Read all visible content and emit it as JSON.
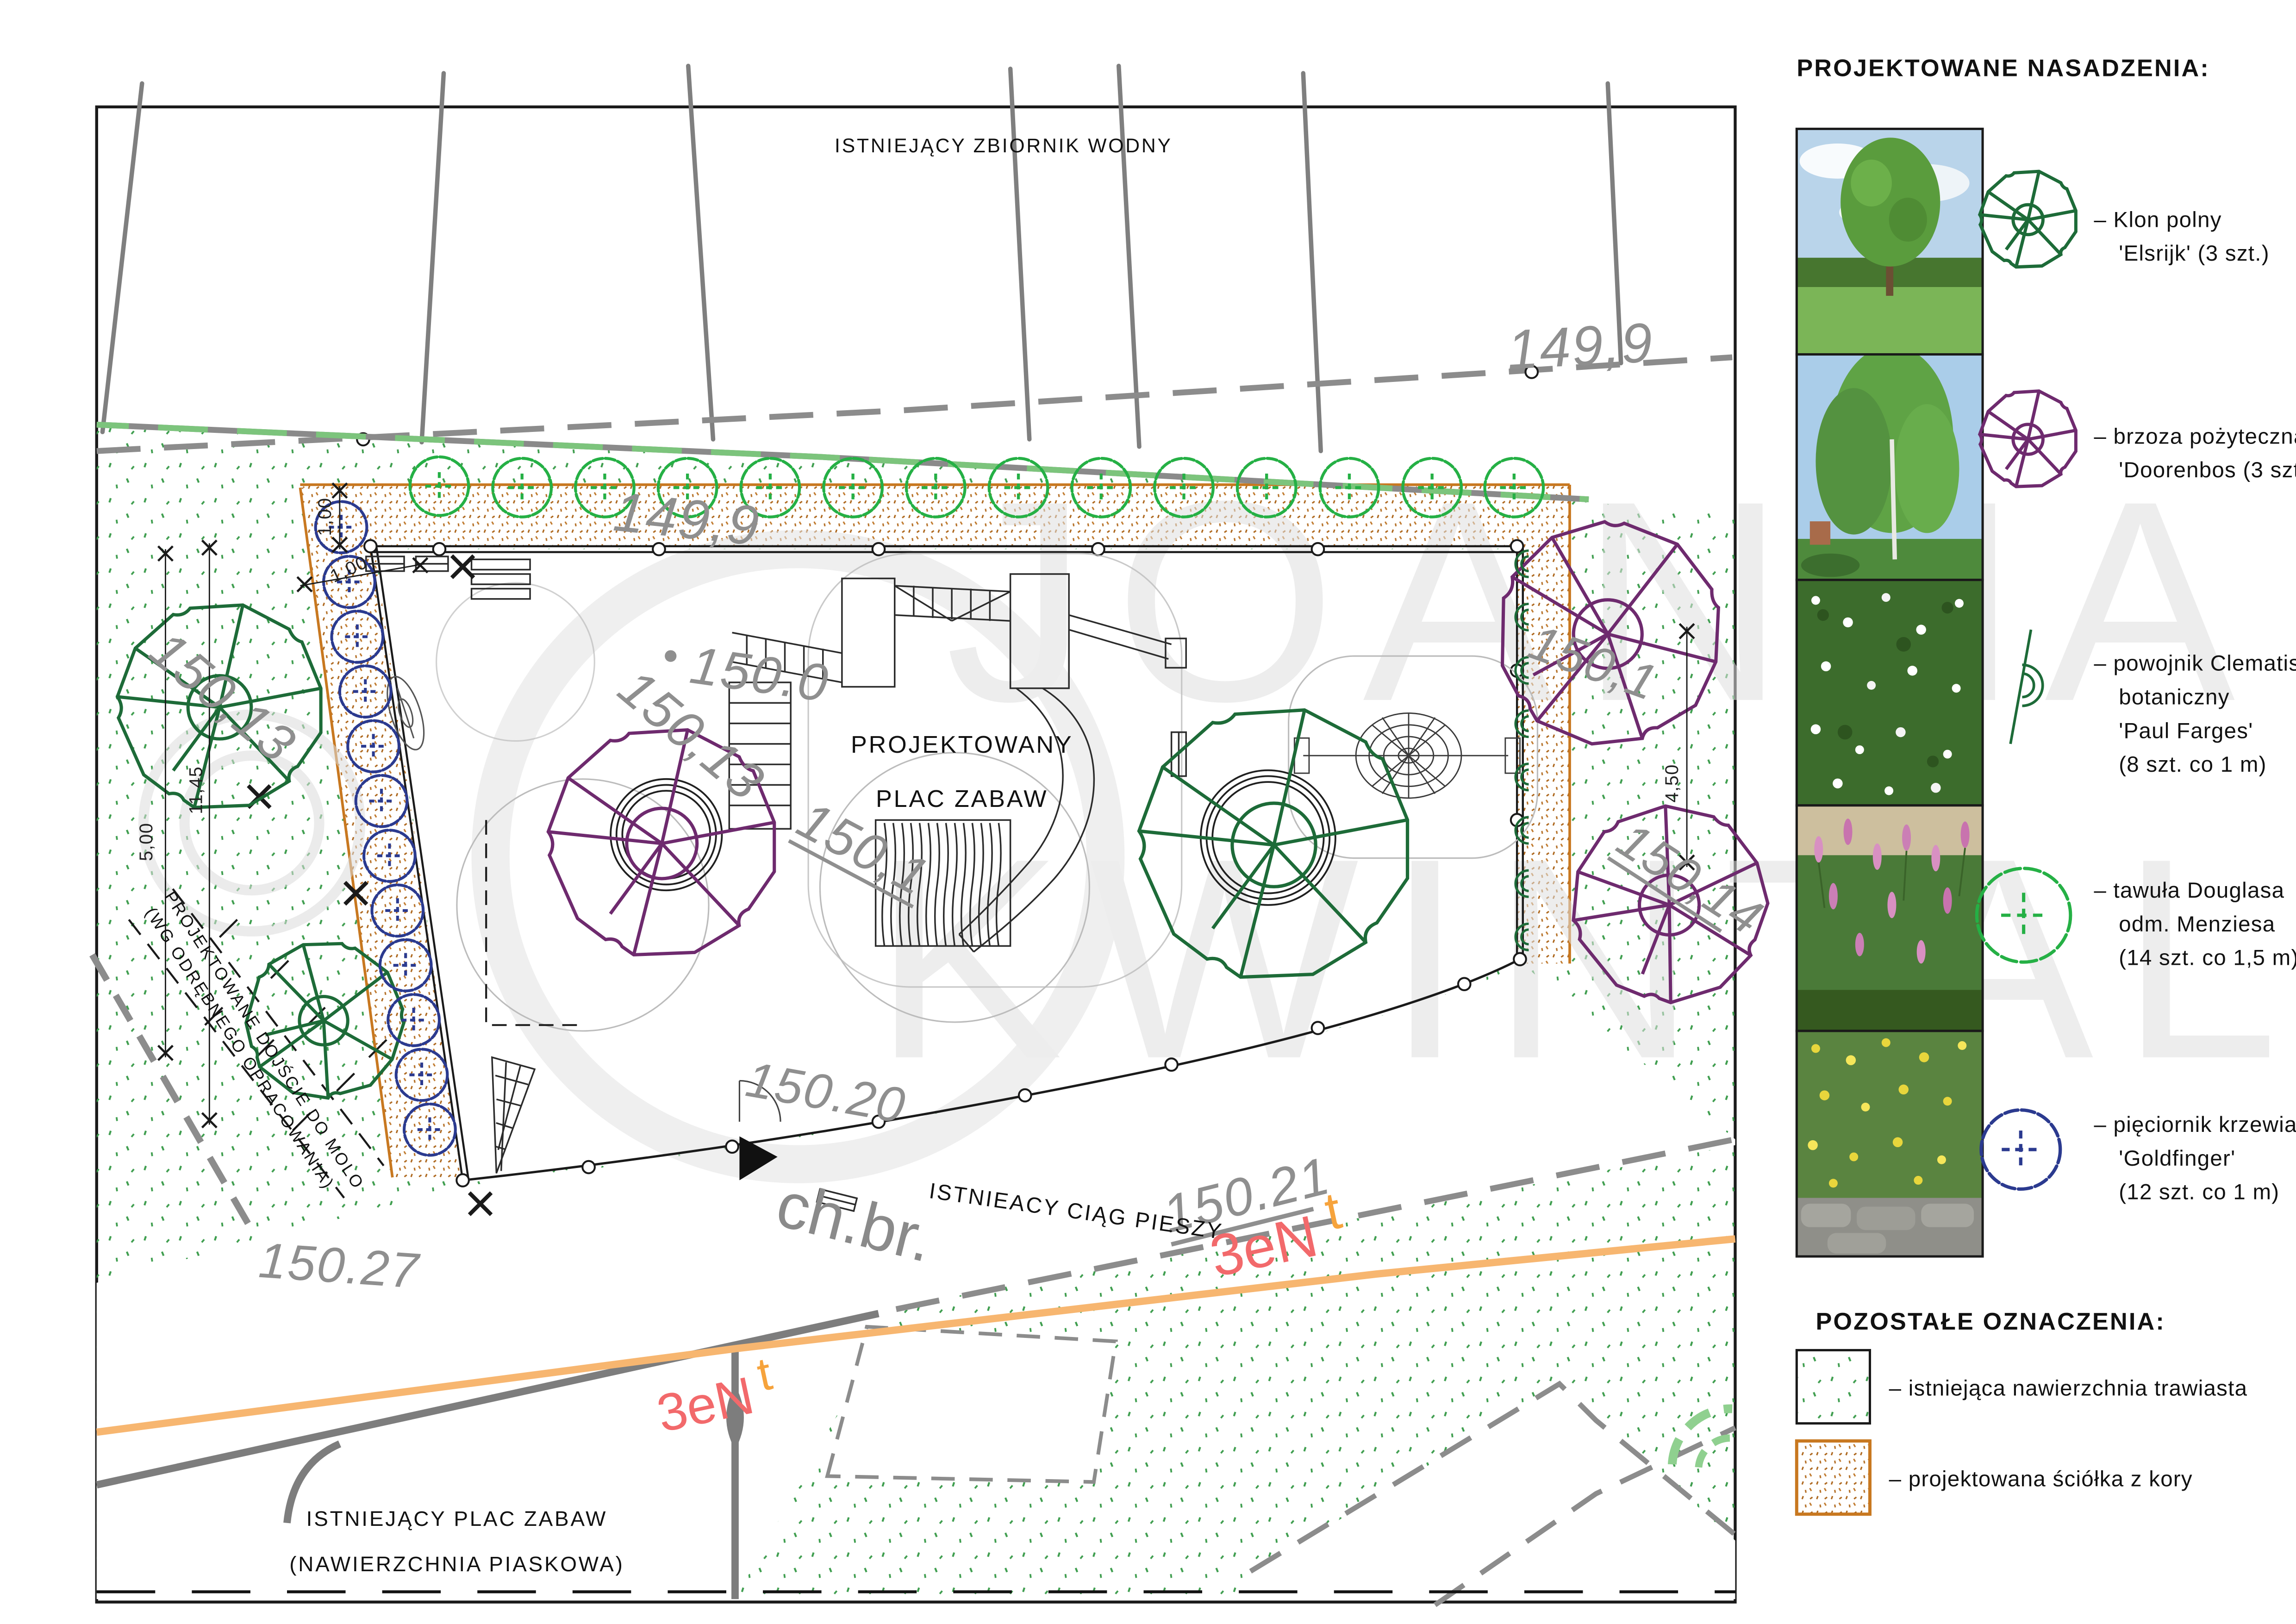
{
  "colors": {
    "klon_green": "#1d6b38",
    "tawula_green": "#25b045",
    "brzoza_purple": "#6e2a6e",
    "pieciornik_blue": "#2b3a8f",
    "fence_green": "#7cc47c",
    "mulch_orange": "#c87820",
    "utility_orange": "#f7b670",
    "utility_label_red": "#f2696b",
    "elevation_gray": "#8f8f8f",
    "watermark_gray": "#dcdcdc"
  },
  "watermark": {
    "line1": "JOANNA",
    "line2": "KWINTAL"
  },
  "plan": {
    "labels": {
      "water": "ISTNIEJĄCY ZBIORNIK WODNY",
      "playground_line1": "PROJEKTOWANY",
      "playground_line2": "PLAC ZABAW",
      "path_abbr": "ch.br.",
      "path_name": "ISTNIEACY CIĄG PIESZY",
      "molo_line1": "PROJEKTOWANE DOJŚCIE DO MOLO",
      "molo_line2": "(WG ODRĘBNEGO OPRACOWANIA)",
      "existing_line1": "ISTNIEJĄCY PLAC ZABAW",
      "existing_line2": "(NAWIERZCHNIA PIASKOWA)"
    },
    "elevations": {
      "boundary_top": "149,9",
      "boundary_top2": "149,9",
      "left": "150,13",
      "left2": "150,13",
      "center_top": "150.0",
      "center": "150,1",
      "right": "150,1",
      "right2": "150,14",
      "path1": "150.20",
      "path2": "150.21",
      "path3": "150.27"
    },
    "utilities": {
      "gas1": "3eN",
      "gas1_t": "t",
      "gas2": "3eN",
      "gas2_t": "t"
    },
    "dimensions": {
      "top_band": "1,00",
      "left_band": "1,00",
      "left_a": "5,00",
      "left_b": "11,45",
      "right": "4,50"
    }
  },
  "legend": {
    "title": "PROJEKTOWANE NASADZENIA:",
    "entries": [
      {
        "id": "klon",
        "lines": [
          "– Klon polny",
          "'Elsrijk' (3 szt.)"
        ]
      },
      {
        "id": "brzoza",
        "lines": [
          "– brzoza pożyteczna",
          "'Doorenbos (3 szt.)"
        ]
      },
      {
        "id": "powojnik",
        "lines": [
          "– powojnik Clematis",
          "botaniczny",
          "'Paul Farges'",
          "(8 szt. co 1 m)"
        ]
      },
      {
        "id": "tawula",
        "lines": [
          "– tawuła Douglasa",
          "odm. Menziesa",
          "(14 szt. co 1,5 m)"
        ]
      },
      {
        "id": "pieciornik",
        "lines": [
          "– pięciornik krzewiasty",
          "'Goldfinger'",
          "(12 szt. co 1 m)"
        ]
      }
    ],
    "other_title": "POZOSTAŁE OZNACZENIA:",
    "other_entries": [
      {
        "id": "grass",
        "label": "– istniejąca nawierzchnia trawiasta"
      },
      {
        "id": "bark",
        "label": "– projektowana ściółka z kory"
      }
    ]
  }
}
